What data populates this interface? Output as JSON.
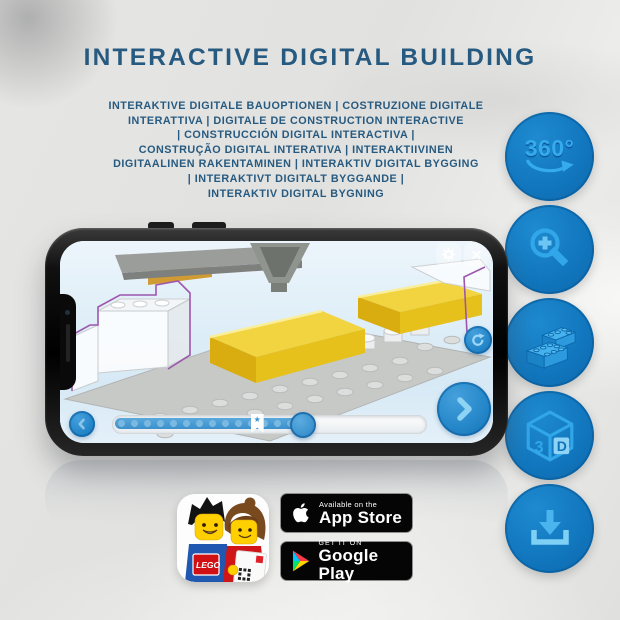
{
  "header": {
    "title": "INTERACTIVE DIGITAL BUILDING",
    "subtitle_lines": [
      "INTERAKTIVE DIGITALE BAUOPTIONEN | COSTRUZIONE DIGITALE",
      "INTERATTIVA | DIGITALE DE CONSTRUCTION INTERACTIVE",
      "| CONSTRUCCIÓN DIGITAL INTERACTIVA |",
      "CONSTRUÇÃO DIGITAL INTERATIVA | INTERAKTIIVINEN",
      "DIGITAALINEN RAKENTAMINEN | INTERAKTIV DIGITAL BYGGING",
      "| INTERAKTIVT DIGITALT BYGGANDE |",
      "INTERAKTIV DIGITAL BYGNING"
    ]
  },
  "feature_icons": {
    "rotation_label": "360°",
    "cube_left_face": "3",
    "cube_right_face": "D"
  },
  "phone_ui": {
    "close_glyph": "✕",
    "bookmark_star": "★"
  },
  "store": {
    "app_store": {
      "tagline": "Available on the",
      "name": "App Store"
    },
    "google_play": {
      "tagline": "GET IT ON",
      "name": "Google Play"
    }
  },
  "app_icon": {
    "logo_text": "LEGO"
  },
  "colors": {
    "heading_blue": "#275a80",
    "feature_circle_blue": "#1176bd",
    "feature_glyph_blue": "#31a7ea",
    "screen_button_blue": "#2e8fd0",
    "slider_fill_blue": "#4398d3",
    "yellow_brick": "#f1d440"
  }
}
